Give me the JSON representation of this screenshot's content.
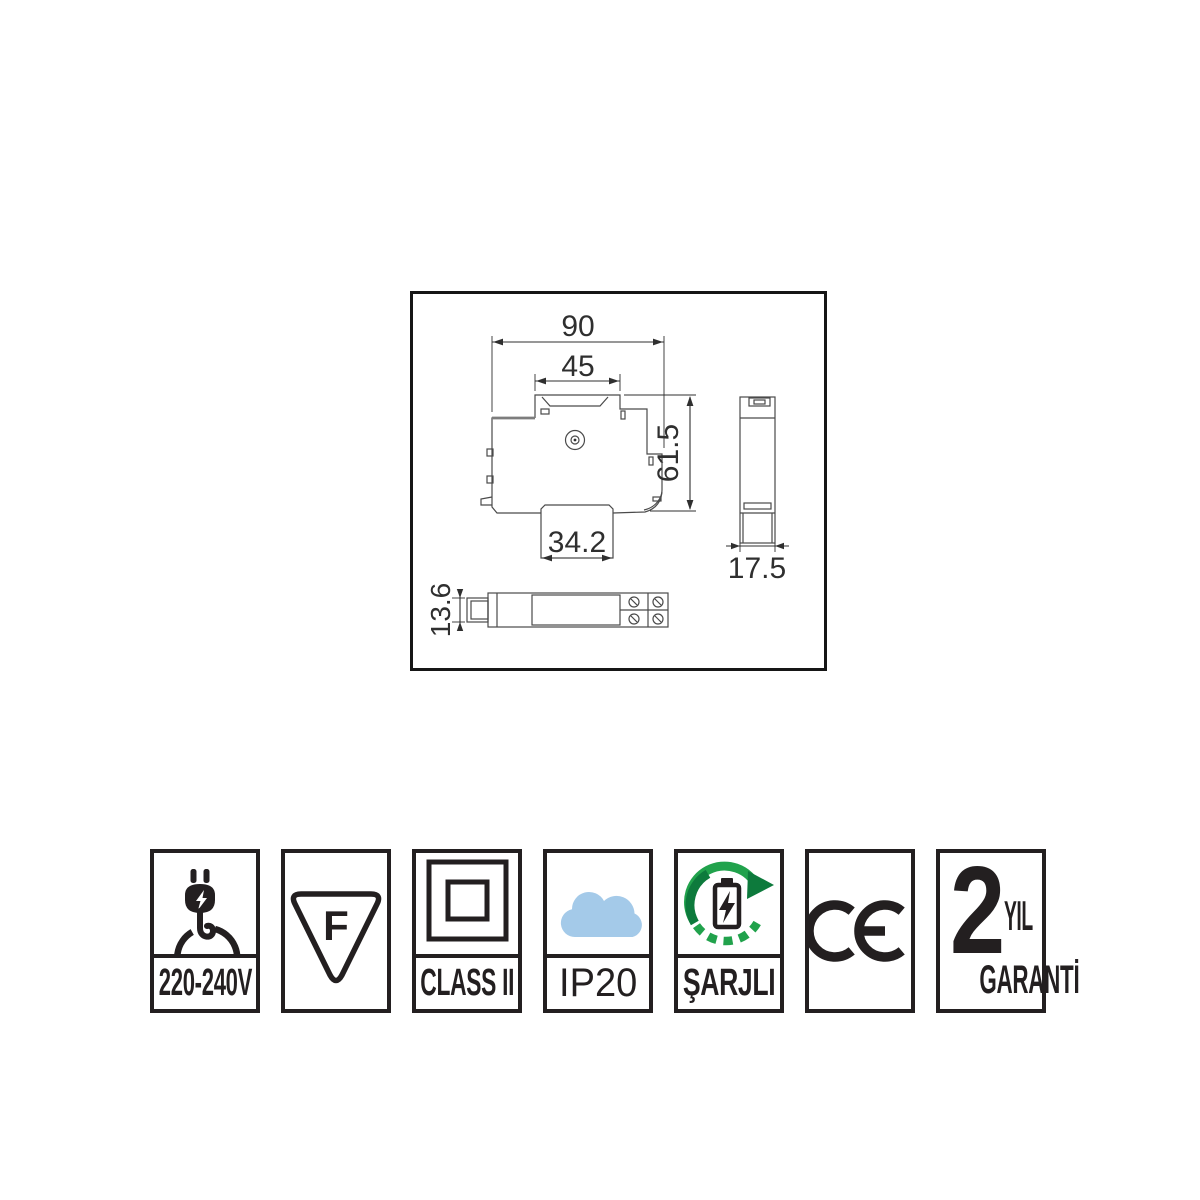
{
  "drawing": {
    "dim_overall_width": "90",
    "dim_top_width": "45",
    "dim_height": "61.5",
    "dim_bottom_width": "34.2",
    "dim_side_width": "17.5",
    "dim_clip_height": "13.6"
  },
  "badges": [
    {
      "name": "voltage",
      "label": "220-240V",
      "icon": "plug-icon"
    },
    {
      "name": "thermal-fuse",
      "letter": "F",
      "icon": "f-triangle-icon"
    },
    {
      "name": "insulation-class",
      "label": "CLASS II",
      "icon": "double-square-icon"
    },
    {
      "name": "ip-rating",
      "label": "IP20",
      "icon": "cloud-icon"
    },
    {
      "name": "rechargeable",
      "label": "ŞARJLI",
      "icon": "battery-recycle-icon"
    },
    {
      "name": "ce-mark",
      "mark": "CE",
      "icon": "ce-icon"
    },
    {
      "name": "warranty",
      "years": "2",
      "unit": "YIL",
      "label": "GARANTİ",
      "icon": "warranty-text"
    }
  ],
  "colors": {
    "ink": "#231f20",
    "line": "#4a4a4a",
    "dim_text": "#2f2f2f",
    "cloud": "#a4cae9",
    "green": "#21a24c",
    "green_dark": "#0d7a3c"
  }
}
